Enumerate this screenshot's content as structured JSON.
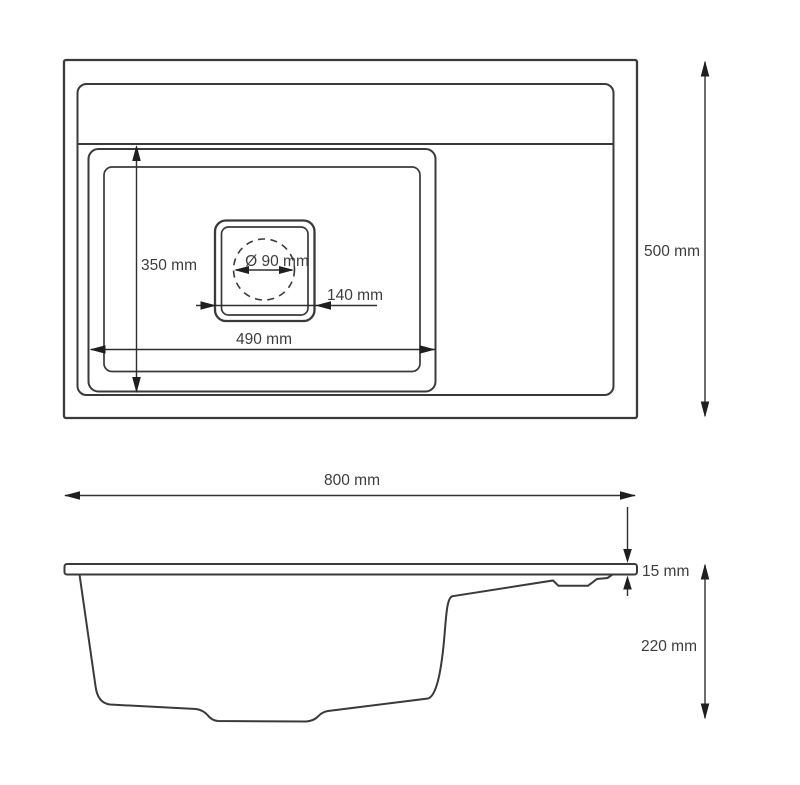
{
  "drawing": {
    "title": "Sink technical drawing, top view and side view",
    "colors": {
      "background": "#ffffff",
      "outline": "#3a3a3a",
      "dimension_line": "#2f2f2f",
      "arrowhead": "#1f1f1f",
      "text": "#3d3d3d"
    },
    "top_view": {
      "dim_bowl_depth": "350 mm",
      "dim_drain_diameter": "Ø 90 mm",
      "dim_drain_width": "140 mm",
      "dim_bowl_width": "490 mm",
      "dim_overall_depth": "500 mm"
    },
    "side_view": {
      "dim_overall_width": "800 mm",
      "dim_rim_thickness": "15 mm",
      "dim_overall_height": "220 mm"
    }
  }
}
